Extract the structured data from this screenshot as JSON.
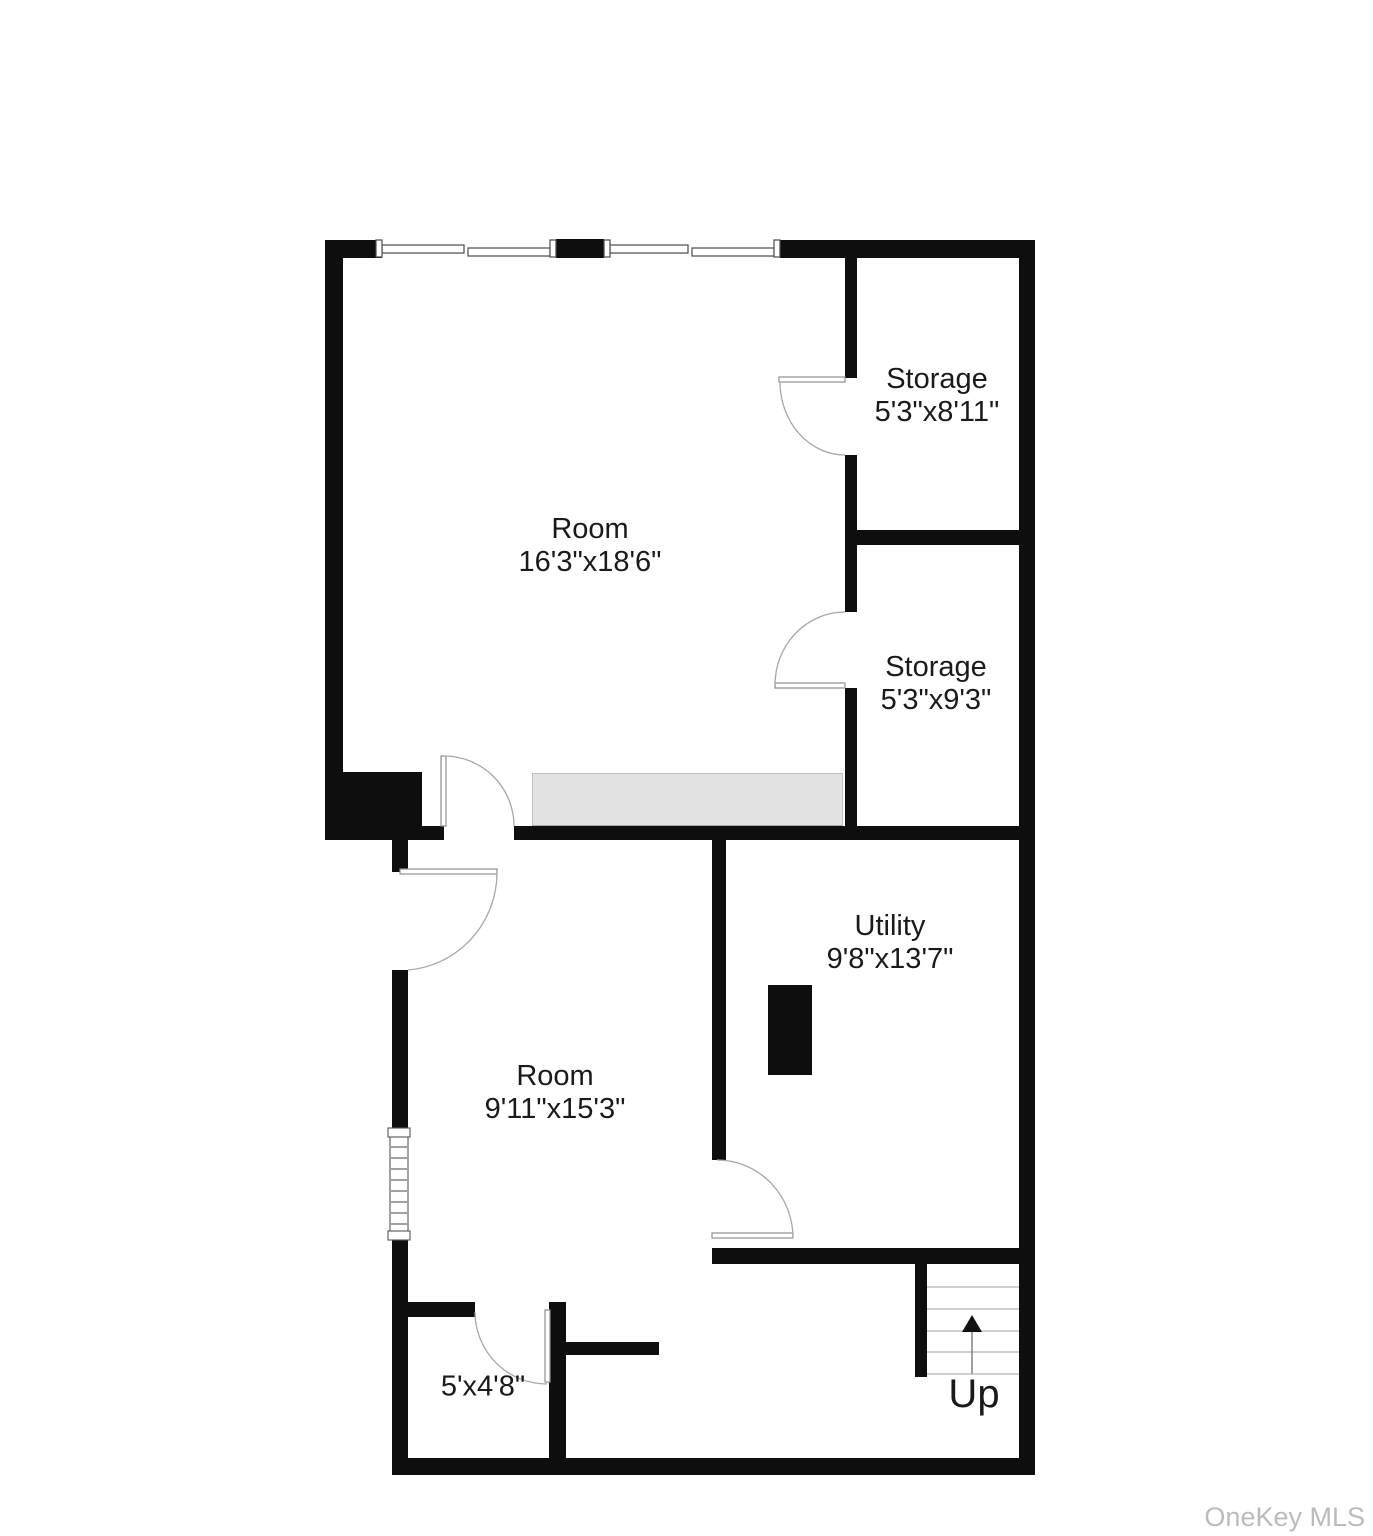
{
  "plan": {
    "rooms": {
      "main": {
        "name": "Room",
        "dims": "16'3\"x18'6\""
      },
      "storage_top": {
        "name": "Storage",
        "dims": "5'3\"x8'11\""
      },
      "storage_mid": {
        "name": "Storage",
        "dims": "5'3\"x9'3\""
      },
      "utility": {
        "name": "Utility",
        "dims": "9'8\"x13'7\""
      },
      "room_lower": {
        "name": "Room",
        "dims": "9'11\"x15'3\""
      },
      "closet": {
        "dims": "5'x4'8\""
      }
    },
    "stairs": {
      "label": "Up"
    },
    "watermark": {
      "text": "OneKey MLS"
    },
    "colors": {
      "wall": "#0e0e0e",
      "background": "#ffffff",
      "landing_fill": "#e2e2e2",
      "door_line": "#a8a8a8",
      "stair_tread": "#cfcfcf",
      "watermark": "#b9bcbf",
      "label_text": "#1a1a1a"
    }
  }
}
